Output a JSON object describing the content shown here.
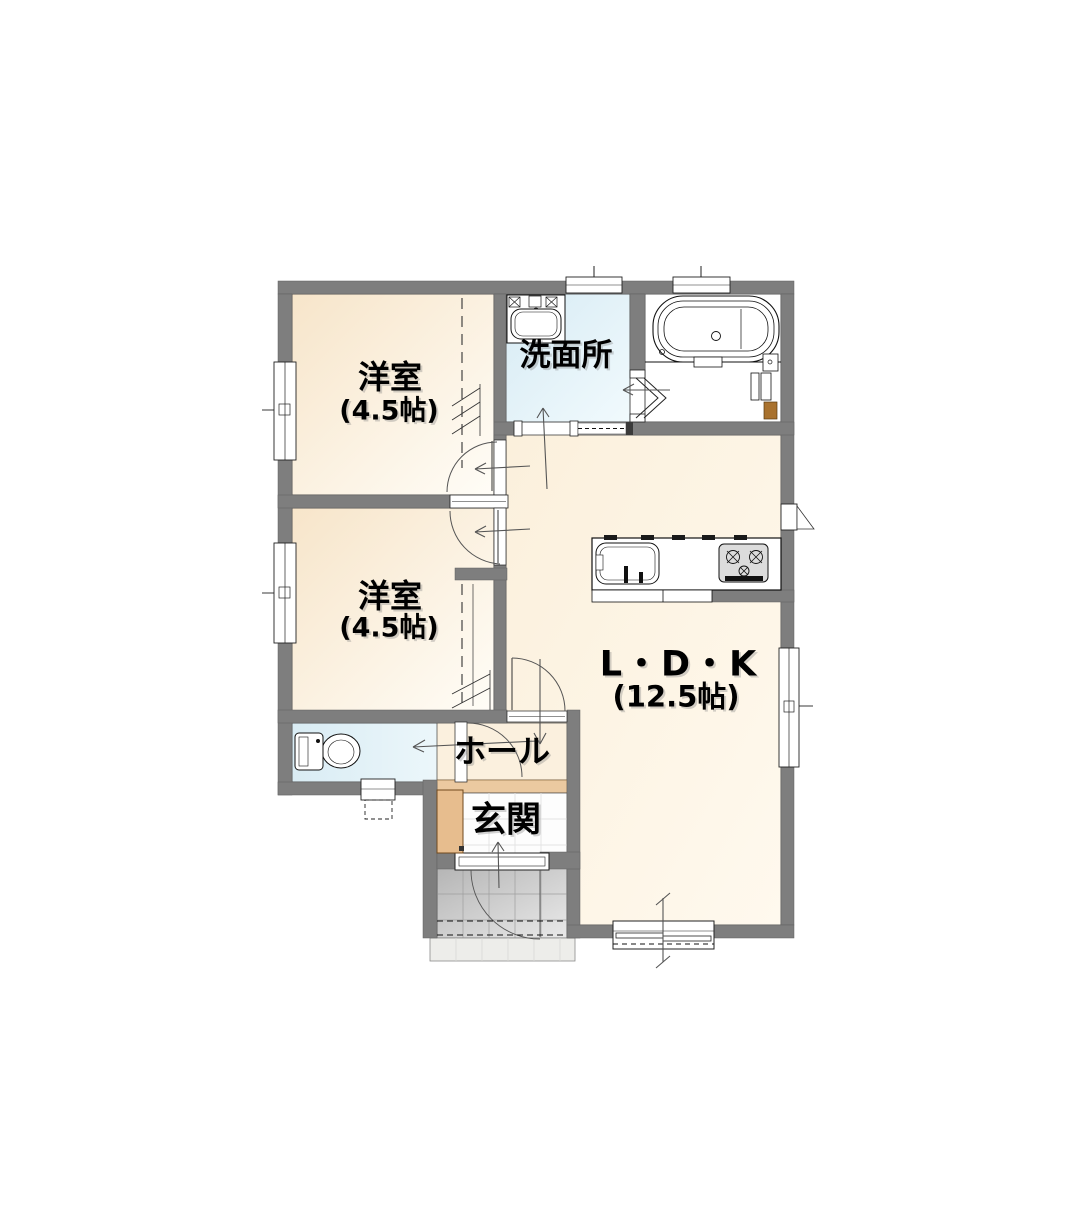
{
  "plan": {
    "rooms": {
      "bedroom1": {
        "name": "洋室",
        "area": "(4.5帖)"
      },
      "bedroom2": {
        "name": "洋室",
        "area": "(4.5帖)"
      },
      "washroom": {
        "name": "洗面所"
      },
      "ldk": {
        "name": "L・D・K",
        "area": "(12.5帖)"
      },
      "hall": {
        "name": "ホール"
      },
      "entrance": {
        "name": "玄関"
      }
    },
    "palette": {
      "wall_gray": "#7e7e7e",
      "bedroom_floor": "#f8e8d0",
      "ldk_floor": "#fdf4e4",
      "wet_area_blue": "#ddeef6",
      "bathroom_white": "#ffffff",
      "entrance_step_tan": "#ebc9a0",
      "shoe_cabinet_tan": "#e7bd8e",
      "porch_gray": "#c4c4c4"
    }
  }
}
